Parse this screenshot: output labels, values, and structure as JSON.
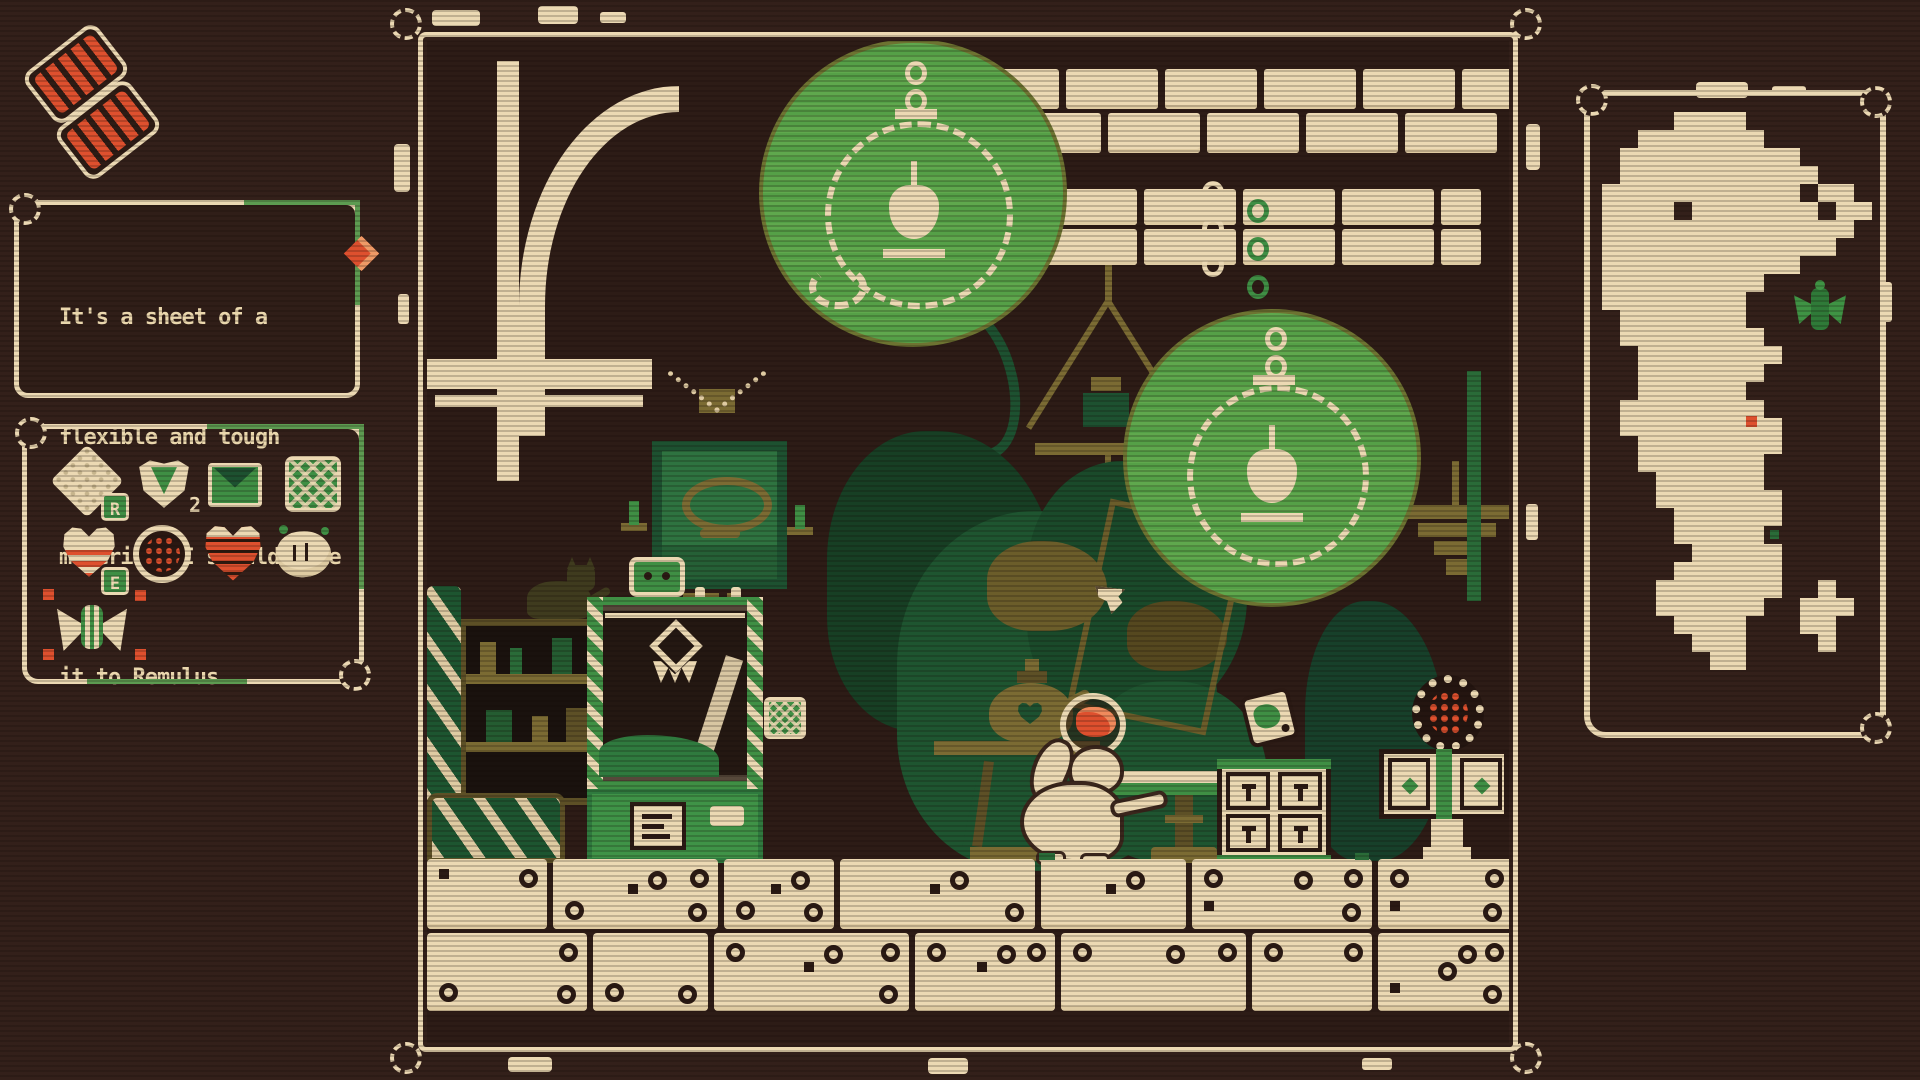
{
  "palette": {
    "background": "#33201a",
    "cream": "#ecd9b3",
    "ui_green": "#5d9b51",
    "glow_green": "#5fa84d",
    "dark_green": "#1d5130",
    "olive": "#7b6b33",
    "red_accent": "#de502e"
  },
  "hud": {
    "held_items": {
      "name": "flexible-sheet",
      "visible_count": 2
    },
    "dialog": {
      "lines": [
        "It's a sheet of a",
        "flexible and tough",
        "material. I should take",
        "it to Remulus."
      ],
      "full_text": "It's a sheet of a flexible and tough material. I should take it to Remulus.",
      "alert_gem": "red-diamond"
    },
    "inventory": {
      "items": [
        {
          "name": "flexible-sheet",
          "badge": "R"
        },
        {
          "name": "dart-shield",
          "count": "2"
        },
        {
          "name": "letter"
        },
        {
          "name": "woven-patch"
        },
        {
          "name": "heart-container",
          "badge": "E"
        },
        {
          "name": "caged-orb"
        },
        {
          "name": "striped-heart"
        },
        {
          "name": "glove"
        },
        {
          "name": "moth-charm",
          "selected": true
        }
      ]
    }
  },
  "scene": {
    "props": [
      "arch",
      "stone-ledge",
      "hanging-lanterns-glow",
      "pendant-lamps",
      "picture-frame",
      "shelf-cabinet",
      "cat",
      "barrels",
      "claw-machine",
      "basket",
      "foliage",
      "teapot",
      "pedestal-table",
      "player-character",
      "bowl-with-red-sheet",
      "side-table",
      "drawer-dresser",
      "dice-cube",
      "cabinet",
      "caged-red-orb",
      "dice-block-floor"
    ],
    "cursor": "small-cream-arrow"
  },
  "minimap": {
    "grid": [
      "....####.......",
      "..#######......",
      ".##########....",
      ".###########...",
      "###########.##.",
      "####.#######.##",
      "##############.",
      "#############..",
      "###########....",
      "#########......",
      "########.......",
      ".#######.......",
      ".########......",
      "..########.....",
      "..#######......",
      "..######.......",
      ".########......",
      ".#########.....",
      "..########.....",
      "..#######......",
      "...######......",
      "...#######.....",
      "....######.....",
      "....#####......",
      ".....#####.....",
      "....######.....",
      "...#######..#..",
      "...######..###.",
      "....####...##..",
      ".....###....#..",
      "......##......."
    ],
    "markers": [
      {
        "type": "player-moth",
        "color": "#3f8f44"
      },
      {
        "type": "poi-red-dot",
        "color": "#de502e"
      },
      {
        "type": "poi-green-dot",
        "color": "#2a6b38"
      }
    ]
  }
}
